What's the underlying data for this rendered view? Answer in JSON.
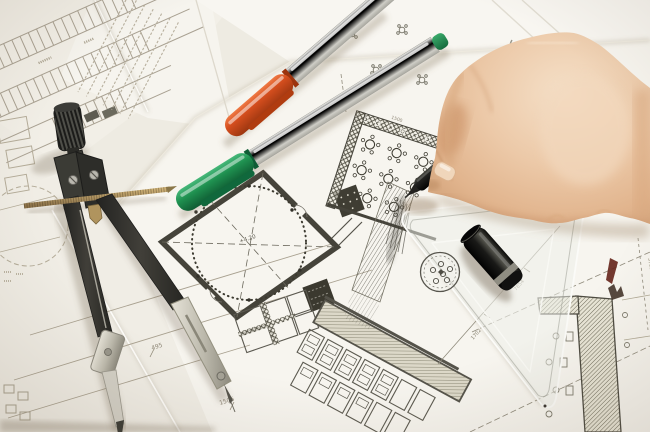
{
  "title": "Hand drawing on architectural blueprints",
  "objects": {
    "hand": {
      "label": "right hand holding black pen",
      "skin_color": "#ecc9a8"
    },
    "black_pen": {
      "label": "black fineliner pen",
      "color": "#1a1a18"
    },
    "pen_cap": {
      "label": "black pen cap",
      "color": "#151513",
      "ring_color": "#95938a"
    },
    "orange_pen": {
      "label": "orange-capped marker",
      "cap_color": "#d54e1e",
      "body_color": "#e9e9e5"
    },
    "green_pen": {
      "label": "green-capped marker",
      "cap_color": "#1f9150",
      "body_color": "#e9e9e5",
      "tail_color": "#2a9a5c"
    },
    "compass": {
      "label": "drafting compass divider",
      "body_color": "#32322e",
      "metal_color": "#cfccc1",
      "rod_color": "#a98f5c"
    },
    "set_square": {
      "label": "transparent set square ruler",
      "stamp": "circular maker stamp"
    }
  },
  "blueprint": {
    "dim_labels": [
      "495",
      "1505",
      "1702",
      "7854",
      "3752",
      "1500",
      "+4.20"
    ],
    "ink_color": "#8f897a",
    "wall_color": "#46443a"
  }
}
